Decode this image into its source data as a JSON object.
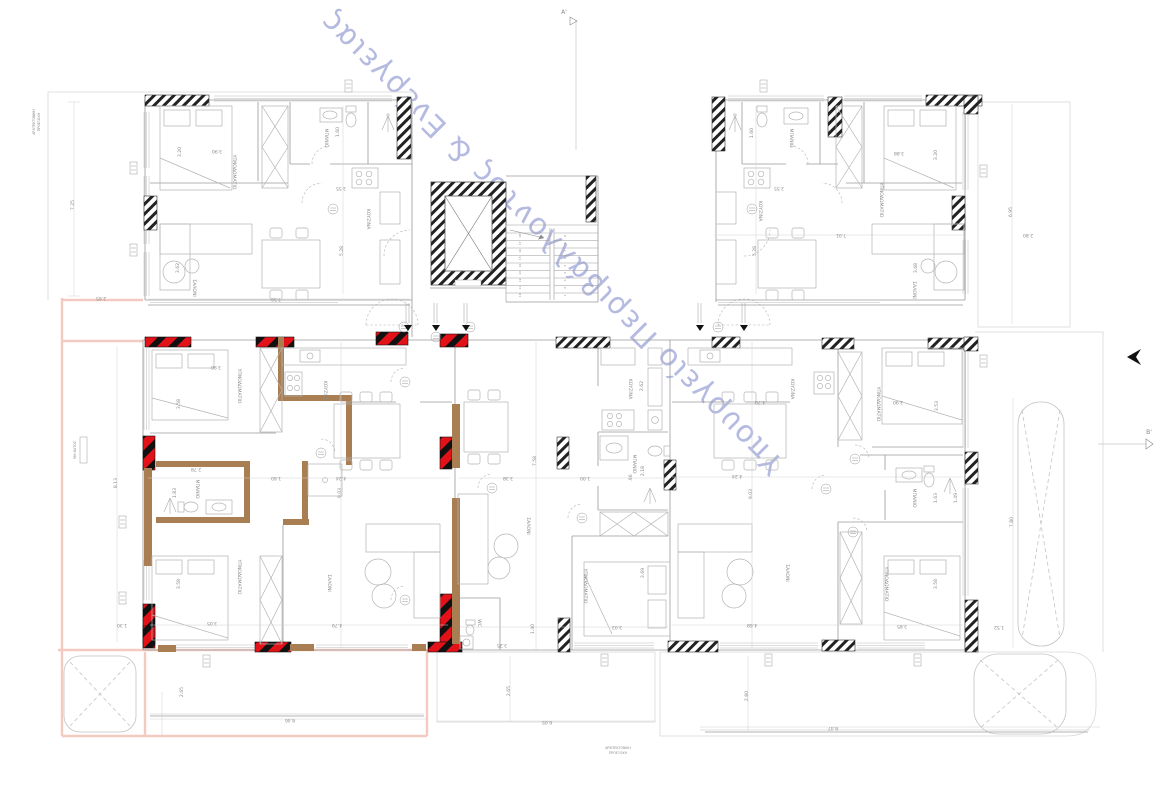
{
  "watermark": {
    "text": "Υπουργείο Περιβάλλοντος & Ενέργειας",
    "color": "#a9afdc"
  },
  "colors": {
    "hatch_black": "#222222",
    "column_red": "#e31219",
    "wall_brown": "#a87e52",
    "balcony_pink": "#f4c9c2",
    "line_gray": "#9a9a9a",
    "furniture_gray": "#b4b4b4",
    "text": "#8a8a8a"
  },
  "labels": [
    {
      "t": "ΥΠΝΟΔΩΜΑΤΙΟ",
      "x": 233,
      "y": 172,
      "r": 90
    },
    {
      "t": "ΜΠΑΝΙΟ",
      "x": 325,
      "y": 138,
      "r": 90
    },
    {
      "t": "ΚΟΥΖΙΝΑ",
      "x": 367,
      "y": 219,
      "r": 90
    },
    {
      "t": "ΣΑΛΟΝΙ",
      "x": 193,
      "y": 288,
      "r": 90
    },
    {
      "t": "ΜΠΑΝΙΟ",
      "x": 790,
      "y": 138,
      "r": 90
    },
    {
      "t": "ΚΟΥΖΙΝΑ",
      "x": 759,
      "y": 211,
      "r": 90
    },
    {
      "t": "ΥΠΝΟΔΩΜΑΤΙΟ",
      "x": 880,
      "y": 200,
      "r": 90
    },
    {
      "t": "ΣΑΛΟΝΙ",
      "x": 913,
      "y": 290,
      "r": 90
    },
    {
      "t": "ΥΠΝΟΔΩΜΑΤΙΟ",
      "x": 238,
      "y": 386,
      "r": 90
    },
    {
      "t": "ΚΟΥΖΙΝΑ",
      "x": 324,
      "y": 391,
      "r": 90
    },
    {
      "t": "ΜΠΑΝΙΟ",
      "x": 196,
      "y": 489,
      "r": 90
    },
    {
      "t": "ΥΠΝΟΔΩΜΑΤΙΟ",
      "x": 238,
      "y": 577,
      "r": 90
    },
    {
      "t": "ΣΑΛΟΝΙ",
      "x": 328,
      "y": 583,
      "r": 90
    },
    {
      "t": "ΚΟΥΖΙΝΑ",
      "x": 629,
      "y": 389,
      "r": 90
    },
    {
      "t": "ΜΠΑΝΙΟ",
      "x": 633,
      "y": 464,
      "r": 90
    },
    {
      "t": "ΣΑΛΟΝΙ",
      "x": 527,
      "y": 526,
      "r": 90
    },
    {
      "t": "ΥΠΝΟΔΩΜΑΤΙΟ",
      "x": 584,
      "y": 586,
      "r": 90
    },
    {
      "t": "WC",
      "x": 478,
      "y": 623,
      "r": 90
    },
    {
      "t": "ΚΟΥΖΙΝΑ",
      "x": 791,
      "y": 389,
      "r": 90
    },
    {
      "t": "ΥΠΝΟΔΩΜΑΤΙΟ",
      "x": 877,
      "y": 404,
      "r": 90
    },
    {
      "t": "ΜΠΑΝΙΟ",
      "x": 913,
      "y": 498,
      "r": 90
    },
    {
      "t": "ΥΠΝΟΔΩΜΑΤΙΟ",
      "x": 885,
      "y": 584,
      "r": 90
    },
    {
      "t": "ΣΑΛΟΝΙ",
      "x": 786,
      "y": 573,
      "r": 90
    },
    {
      "t": "ΑΡΧΙΤΕΚΤΟΝΙΚΗ",
      "x": 35,
      "y": 122,
      "r": -90,
      "s": 3.2,
      "n": "note-arch-projection"
    },
    {
      "t": "ΠΡΟΕΞΟΧΗ",
      "x": 40,
      "y": 122,
      "r": -90,
      "s": 3.2,
      "n": "note-arch-projection"
    },
    {
      "t": "ΑΡΧΙΤΕΚΤΟΝΙΚΗ",
      "x": 618,
      "y": 749,
      "s": 3.2,
      "n": "note-arch-projection"
    },
    {
      "t": "ΠΡΟΕΞΟΧΗ",
      "x": 618,
      "y": 754,
      "s": 3.2,
      "n": "note-arch-projection"
    },
    {
      "t": "ΜΗ ΒΑΤΟΣ",
      "x": 76,
      "y": 450,
      "r": -90,
      "s": 3.4,
      "n": "note-non-walkable"
    },
    {
      "t": "Α'",
      "x": 564,
      "y": 14,
      "s": 6,
      "n": "section-marker-a"
    },
    {
      "t": "Β'",
      "x": 1149,
      "y": 434,
      "s": 6,
      "n": "section-marker-b"
    }
  ],
  "dims": [
    {
      "t": "7.25",
      "x": 74,
      "y": 205,
      "r": -90
    },
    {
      "t": "2.65",
      "x": 101,
      "y": 297,
      "r": 180
    },
    {
      "t": "8.13",
      "x": 117,
      "y": 483,
      "r": -90
    },
    {
      "t": "1.30",
      "x": 122,
      "y": 624,
      "r": 180
    },
    {
      "t": "2.65",
      "x": 183,
      "y": 692,
      "r": -90
    },
    {
      "t": "8.46",
      "x": 290,
      "y": 719,
      "r": 180
    },
    {
      "t": "2.65",
      "x": 510,
      "y": 691,
      "r": -90
    },
    {
      "t": "6.05",
      "x": 547,
      "y": 721,
      "r": 180
    },
    {
      "t": "2.80",
      "x": 748,
      "y": 696,
      "r": -90
    },
    {
      "t": "8.47",
      "x": 833,
      "y": 727,
      "r": 180
    },
    {
      "t": "6.95",
      "x": 1012,
      "y": 212,
      "r": -90
    },
    {
      "t": "2.80",
      "x": 1028,
      "y": 234,
      "r": 180
    },
    {
      "t": "7.80",
      "x": 1013,
      "y": 522,
      "r": -90
    },
    {
      "t": "1.52",
      "x": 999,
      "y": 626,
      "r": 180
    },
    {
      "t": "3.20",
      "x": 181,
      "y": 152,
      "r": -90
    },
    {
      "t": "3.90",
      "x": 217,
      "y": 150,
      "r": 180
    },
    {
      "t": "1.60",
      "x": 339,
      "y": 132,
      "r": -90
    },
    {
      "t": "3.55",
      "x": 341,
      "y": 187,
      "r": 180
    },
    {
      "t": "5.28",
      "x": 343,
      "y": 251,
      "r": -90
    },
    {
      "t": "7.56",
      "x": 276,
      "y": 298,
      "r": 180
    },
    {
      "t": "3.62",
      "x": 179,
      "y": 268,
      "r": -90
    },
    {
      "t": "1.60",
      "x": 753,
      "y": 133,
      "r": -90
    },
    {
      "t": "3.55",
      "x": 779,
      "y": 187,
      "r": 180
    },
    {
      "t": "3.88",
      "x": 899,
      "y": 152,
      "r": 180
    },
    {
      "t": "3.20",
      "x": 937,
      "y": 155,
      "r": -90
    },
    {
      "t": "7.01",
      "x": 841,
      "y": 234,
      "r": 180
    },
    {
      "t": "5.28",
      "x": 756,
      "y": 251,
      "r": -90
    },
    {
      "t": "3.68",
      "x": 917,
      "y": 268,
      "r": -90
    },
    {
      "t": "3.58",
      "x": 180,
      "y": 404,
      "r": -90
    },
    {
      "t": "3.90",
      "x": 216,
      "y": 366,
      "r": 180
    },
    {
      "t": "2.78",
      "x": 196,
      "y": 468,
      "r": 180
    },
    {
      "t": "1.83",
      "x": 176,
      "y": 493,
      "r": -90
    },
    {
      "t": "1.60",
      "x": 276,
      "y": 477,
      "r": 180
    },
    {
      "t": "4.24",
      "x": 341,
      "y": 477,
      "r": 180
    },
    {
      "t": "9.03",
      "x": 341,
      "y": 493,
      "r": -90
    },
    {
      "t": "3.58",
      "x": 180,
      "y": 584,
      "r": -90
    },
    {
      "t": "3.05",
      "x": 212,
      "y": 622,
      "r": 180
    },
    {
      "t": "4.79",
      "x": 337,
      "y": 624,
      "r": 180
    },
    {
      "t": "2.62",
      "x": 643,
      "y": 386,
      "r": -90
    },
    {
      "t": "7.58",
      "x": 536,
      "y": 461,
      "r": -90
    },
    {
      "t": "3.38",
      "x": 508,
      "y": 477,
      "r": 180
    },
    {
      "t": "1.00",
      "x": 585,
      "y": 477,
      "r": 180
    },
    {
      "t": "2.18",
      "x": 644,
      "y": 471,
      "r": -90
    },
    {
      "t": ".96",
      "x": 632,
      "y": 478,
      "r": -90
    },
    {
      "t": "3.69",
      "x": 644,
      "y": 573,
      "r": -90
    },
    {
      "t": "3.03",
      "x": 617,
      "y": 626,
      "r": 180
    },
    {
      "t": "1.40",
      "x": 534,
      "y": 629,
      "r": -90
    },
    {
      "t": "3.25",
      "x": 502,
      "y": 644,
      "r": 180
    },
    {
      "t": "4.79",
      "x": 760,
      "y": 401,
      "r": 180
    },
    {
      "t": "3.90",
      "x": 898,
      "y": 401,
      "r": 180
    },
    {
      "t": "3.53",
      "x": 938,
      "y": 406,
      "r": -90
    },
    {
      "t": "4.24",
      "x": 737,
      "y": 475,
      "r": 180
    },
    {
      "t": "9.03",
      "x": 752,
      "y": 494,
      "r": -90
    },
    {
      "t": "1.63",
      "x": 937,
      "y": 498,
      "r": -90
    },
    {
      "t": "1.49",
      "x": 957,
      "y": 498,
      "r": -90
    },
    {
      "t": "3.58",
      "x": 937,
      "y": 584,
      "r": -90
    },
    {
      "t": "3.85",
      "x": 902,
      "y": 625,
      "r": 180
    },
    {
      "t": "4.68",
      "x": 752,
      "y": 624,
      "r": 180
    }
  ],
  "stairs": {
    "flight_left": [
      "18",
      "17",
      "16",
      "15",
      "14",
      "13",
      "12",
      "11",
      "10"
    ],
    "flight_right": [
      "9",
      "8",
      "7",
      "6",
      "5",
      "4",
      "3",
      "2",
      "1"
    ]
  }
}
